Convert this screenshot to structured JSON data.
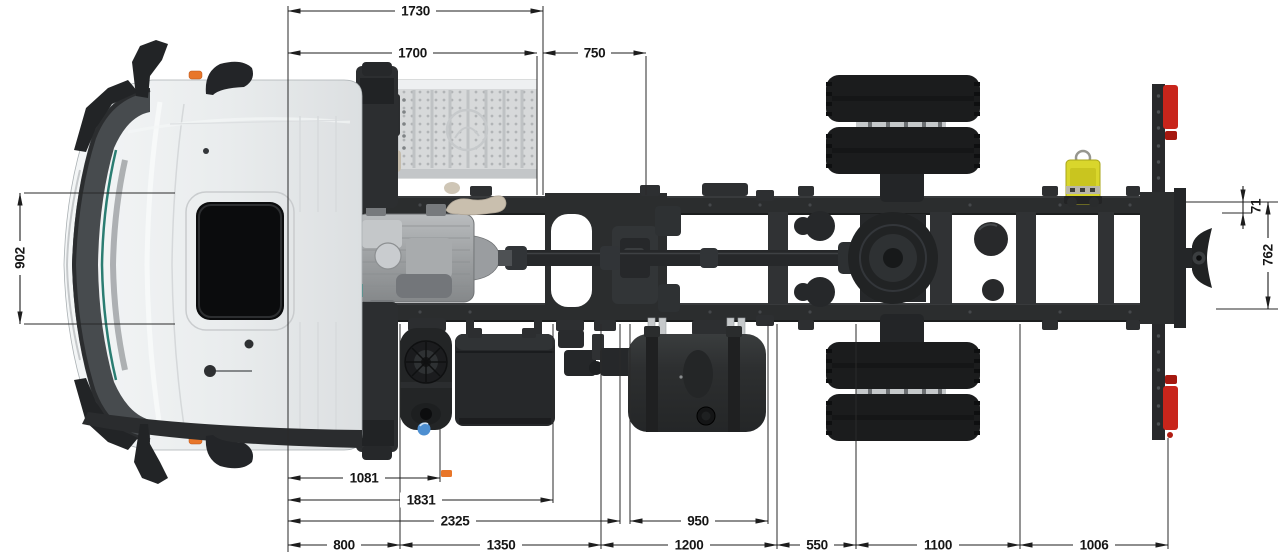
{
  "dimensions": {
    "top": [
      {
        "value": "1730"
      },
      {
        "value": "1700"
      },
      {
        "value": "750"
      }
    ],
    "left": [
      {
        "value": "902"
      }
    ],
    "right": [
      {
        "value": "71"
      },
      {
        "value": "762"
      }
    ],
    "bottom": [
      {
        "value": "1081"
      },
      {
        "value": "1831"
      },
      {
        "value": "2325"
      },
      {
        "value": "950"
      },
      {
        "value": "800"
      },
      {
        "value": "1350"
      },
      {
        "value": "1200"
      },
      {
        "value": "550"
      },
      {
        "value": "1100"
      },
      {
        "value": "1006"
      }
    ]
  },
  "colors": {
    "background": "#ffffff",
    "dimension_line": "#1d1d1d",
    "chassis_dark": "#2b2d2e",
    "tire_black": "#1b1c1d",
    "cab_white": "#e9ecee",
    "transmission_silver": "#a9acae",
    "deck_plate_gray": "#d7d9da",
    "exhaust_tan": "#c9bfae",
    "unit_yellow": "#d9d62c",
    "lamp_red": "#c8251b",
    "marker_orange": "#e8762a",
    "cap_blue": "#4d8fd1",
    "trim_teal": "#2a7d72"
  },
  "components": [
    "cab",
    "sunroof-hatch",
    "door-mirror",
    "deck-plate",
    "frame-rail",
    "transmission",
    "driveshaft",
    "rear-axle",
    "dual-wheels",
    "air-tank",
    "brake-chamber",
    "fuel-tank",
    "battery-box",
    "muffler",
    "rear-lamp",
    "tow-coupling",
    "yellow-unit",
    "exhaust-pipe"
  ]
}
